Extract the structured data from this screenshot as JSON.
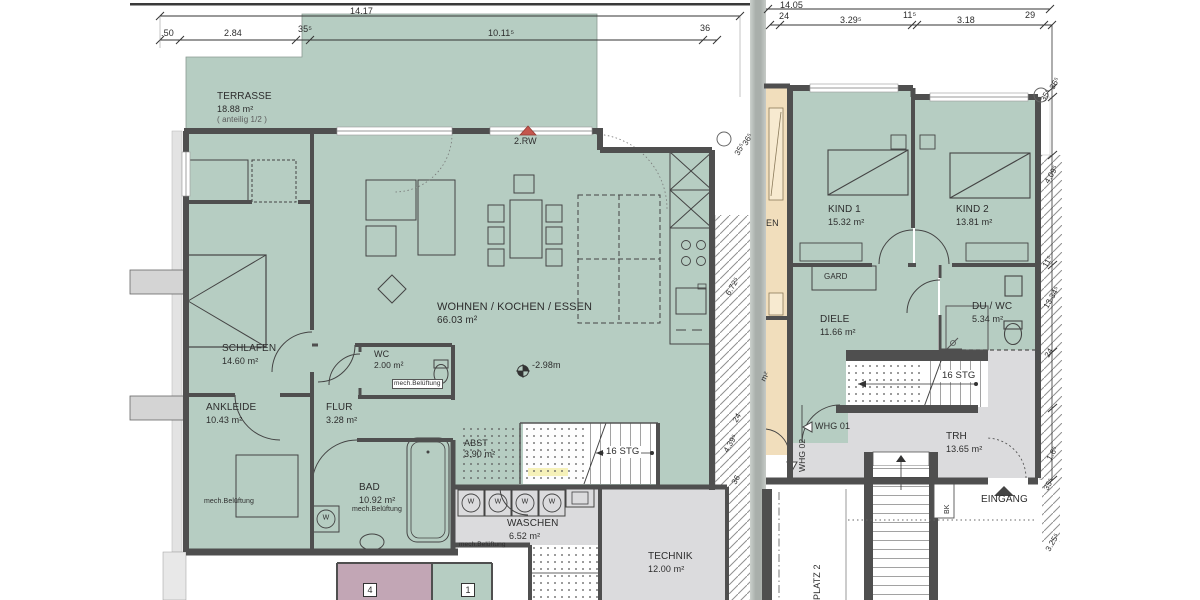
{
  "colors": {
    "room_green": "#b6cdc2",
    "room_gray": "#dbdbdd",
    "room_tan": "#f1debc",
    "room_purple": "#c2a6b5",
    "wall": "#4f4f4f",
    "line": "#3c3c3c",
    "escape_red": "#c4564d",
    "divider": "#b2b8b4",
    "highlight_yellow": "#f4efad"
  },
  "left_plan": {
    "top_total_dim": "14.17",
    "top_dims": [
      ".50",
      "2.84",
      "35⁵",
      "10.11⁵",
      "36"
    ],
    "rooms": {
      "terrasse": {
        "name": "TERRASSE",
        "area": "18.88 m²",
        "note": "( anteilig 1/2 )"
      },
      "wohnen": {
        "name": "WOHNEN / KOCHEN / ESSEN",
        "area": "66.03 m²"
      },
      "schlafen": {
        "name": "SCHLAFEN",
        "area": "14.60 m²"
      },
      "ankleide": {
        "name": "ANKLEIDE",
        "area": "10.43 m²",
        "vent": "mech.Belüftung"
      },
      "wc": {
        "name": "WC",
        "area": "2.00 m²",
        "vent": "mech.Belüftung"
      },
      "flur": {
        "name": "FLUR",
        "area": "3.28 m²"
      },
      "bad": {
        "name": "BAD",
        "area": "10.92 m²",
        "vent": "mech.Belüftung"
      },
      "abst": {
        "name": "ABST",
        "area": "3.90 m²"
      },
      "waschen": {
        "name": "WASCHEN",
        "area": "6.52 m²",
        "vent": "mech.Belüftung"
      },
      "technik": {
        "name": "TECHNIK",
        "area": "12.00 m²"
      }
    },
    "stairs_label": "16 STG",
    "escape_label": "2.RW",
    "level_label": "-2.98m",
    "side_dims": [
      "35⁵",
      "36⁵",
      "6.72⁵",
      "24",
      "4.39⁵",
      "36"
    ],
    "washer_label": "W",
    "unit_labels": [
      "4",
      "1"
    ]
  },
  "right_plan": {
    "top_total_dim": "14.05",
    "top_dims": [
      "24",
      "3.29⁵",
      "11⁵",
      "3.18",
      "29"
    ],
    "rooms": {
      "kind1": {
        "name": "KIND 1",
        "area": "15.32 m²"
      },
      "kind2": {
        "name": "KIND 2",
        "area": "13.81 m²"
      },
      "diele": {
        "name": "DIELE",
        "area": "11.66 m²"
      },
      "duwc": {
        "name": "DU / WC",
        "area": "5.34 m²"
      },
      "trh": {
        "name": "TRH",
        "area": "13.65 m²"
      }
    },
    "gard_label": "GARD",
    "stairs_label": "16 STG",
    "whg01_label": "WHG 01",
    "whg02_label": "WHG 02",
    "eingang_label": "EINGANG",
    "bk_label": "BK",
    "platz2_label": "PLATZ 2",
    "cut_room_label": "EN",
    "cut_room_area": "m²",
    "side_dims": [
      "36⁵",
      "35⁵",
      "4.09⁵",
      "11⁵",
      "13.34⁵",
      "24",
      "1.8⁵",
      "35⁵",
      "3.25⁵"
    ]
  }
}
